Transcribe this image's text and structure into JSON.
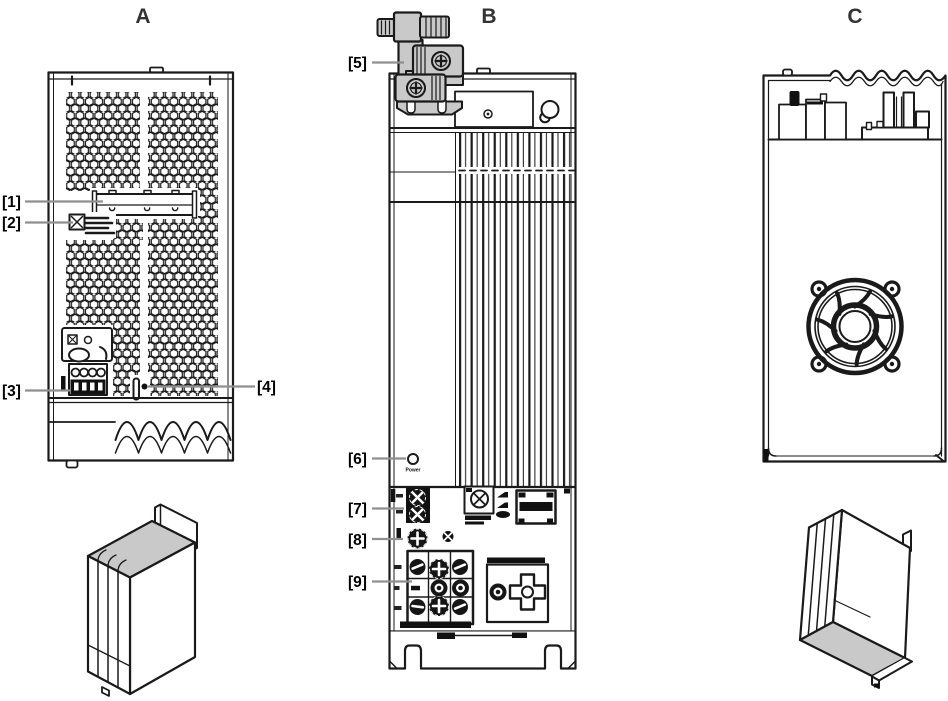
{
  "figure": {
    "views": [
      {
        "label": "A"
      },
      {
        "label": "B"
      },
      {
        "label": "C"
      }
    ],
    "callouts": [
      {
        "label": "[1]"
      },
      {
        "label": "[2]"
      },
      {
        "label": "[3]"
      },
      {
        "label": "[4]"
      },
      {
        "label": "[5]"
      },
      {
        "label": "[6]"
      },
      {
        "label": "[7]"
      },
      {
        "label": "[8]"
      },
      {
        "label": "[9]"
      }
    ],
    "annotations": {
      "power_led_label": "Power"
    },
    "colors": {
      "line": "#1a1a1a",
      "leader": "#8f8f8f",
      "gray_fill": "#c9c9c9",
      "label": "#333333",
      "background": "#ffffff"
    }
  }
}
